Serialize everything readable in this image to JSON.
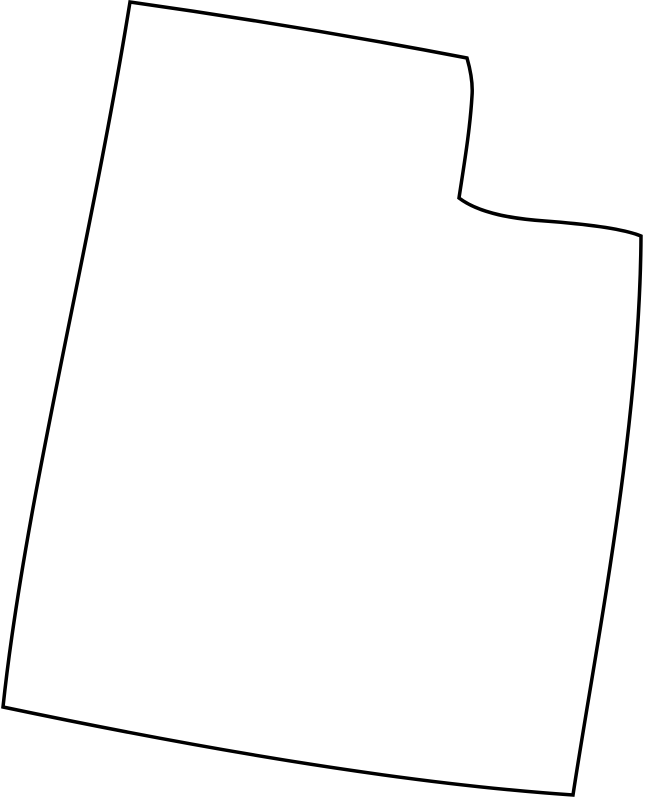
{
  "page": {
    "background_color": "#ffffff",
    "content": "blank-state-outline-map"
  },
  "map": {
    "region": "utah",
    "stroke_color": "#000000",
    "fill_color": "#ffffff",
    "stroke_width": 3.5,
    "outline_path": "M 130 2 Q 300 26 467 58 C 471 72 473 84 472 96 C 470 130 464 165 459 198 C 480 214 515 219 545 221 C 585 224 624 229 641 236 C 640 430 595 650 573 795 Q 350 780 3 707 C 25 500 90 250 130 2 Z"
  }
}
